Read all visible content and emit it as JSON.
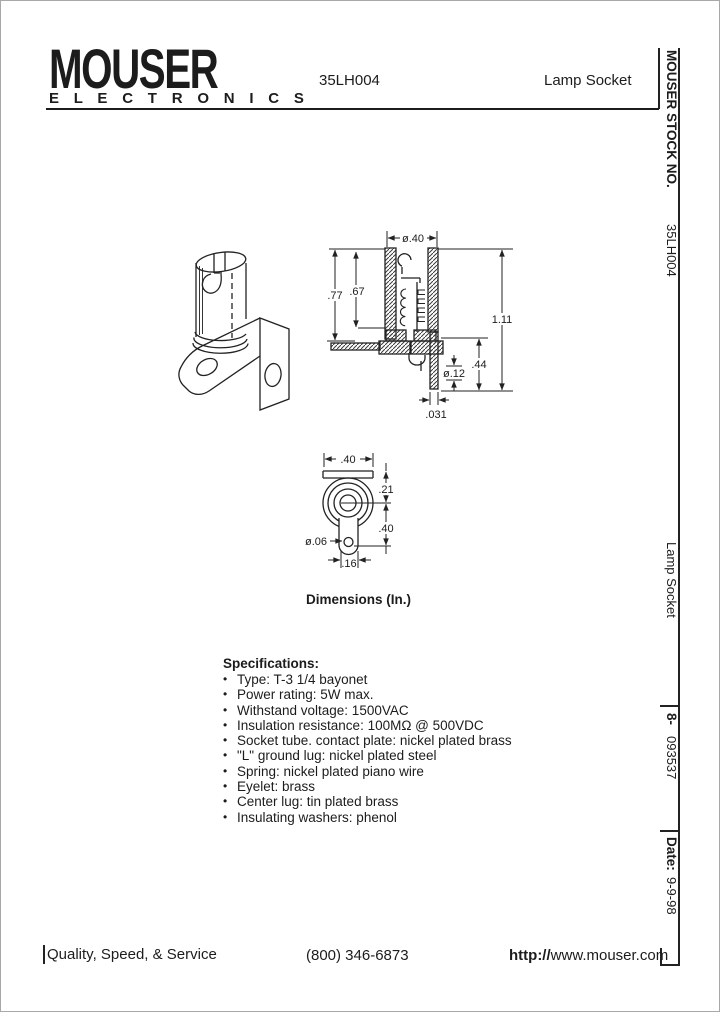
{
  "header": {
    "brand": "MOUSER",
    "brand_sub": "E L E C T R O N I C S",
    "part_number": "35LH004",
    "product_name": "Lamp Socket"
  },
  "sidebar": {
    "stock_label": "MOUSER STOCK NO.",
    "part_number": "35LH004",
    "product_name": "Lamp Socket",
    "stock_prefix": "8-",
    "stock_number": "093537",
    "date_label": "Date:",
    "date_value": "9-9-98"
  },
  "drawing": {
    "caption": "Dimensions (In.)",
    "dims": {
      "dia40": "ø.40",
      "d77": ".77",
      "d67": ".67",
      "d111": "1.11",
      "d44": ".44",
      "dia12": "ø.12",
      "d031": ".031",
      "w40": ".40",
      "d21": ".21",
      "d40b": ".40",
      "dia06": "ø.06",
      "w16": ".16"
    }
  },
  "specifications": {
    "title": "Specifications:",
    "items": [
      "Type:  T-3 1/4 bayonet",
      "Power rating:  5W max.",
      "Withstand voltage:  1500VAC",
      "Insulation resistance:  100MΩ @ 500VDC",
      "Socket tube. contact plate:  nickel plated brass",
      "\"L\" ground lug:  nickel plated steel",
      "Spring:  nickel plated piano wire",
      "Eyelet:  brass",
      "Center lug:  tin plated brass",
      "Insulating washers:  phenol"
    ]
  },
  "footer": {
    "tagline": "Quality, Speed, & Service",
    "phone": "(800) 346-6873",
    "url_prefix": "http://",
    "url_rest": "www.mouser.com"
  }
}
